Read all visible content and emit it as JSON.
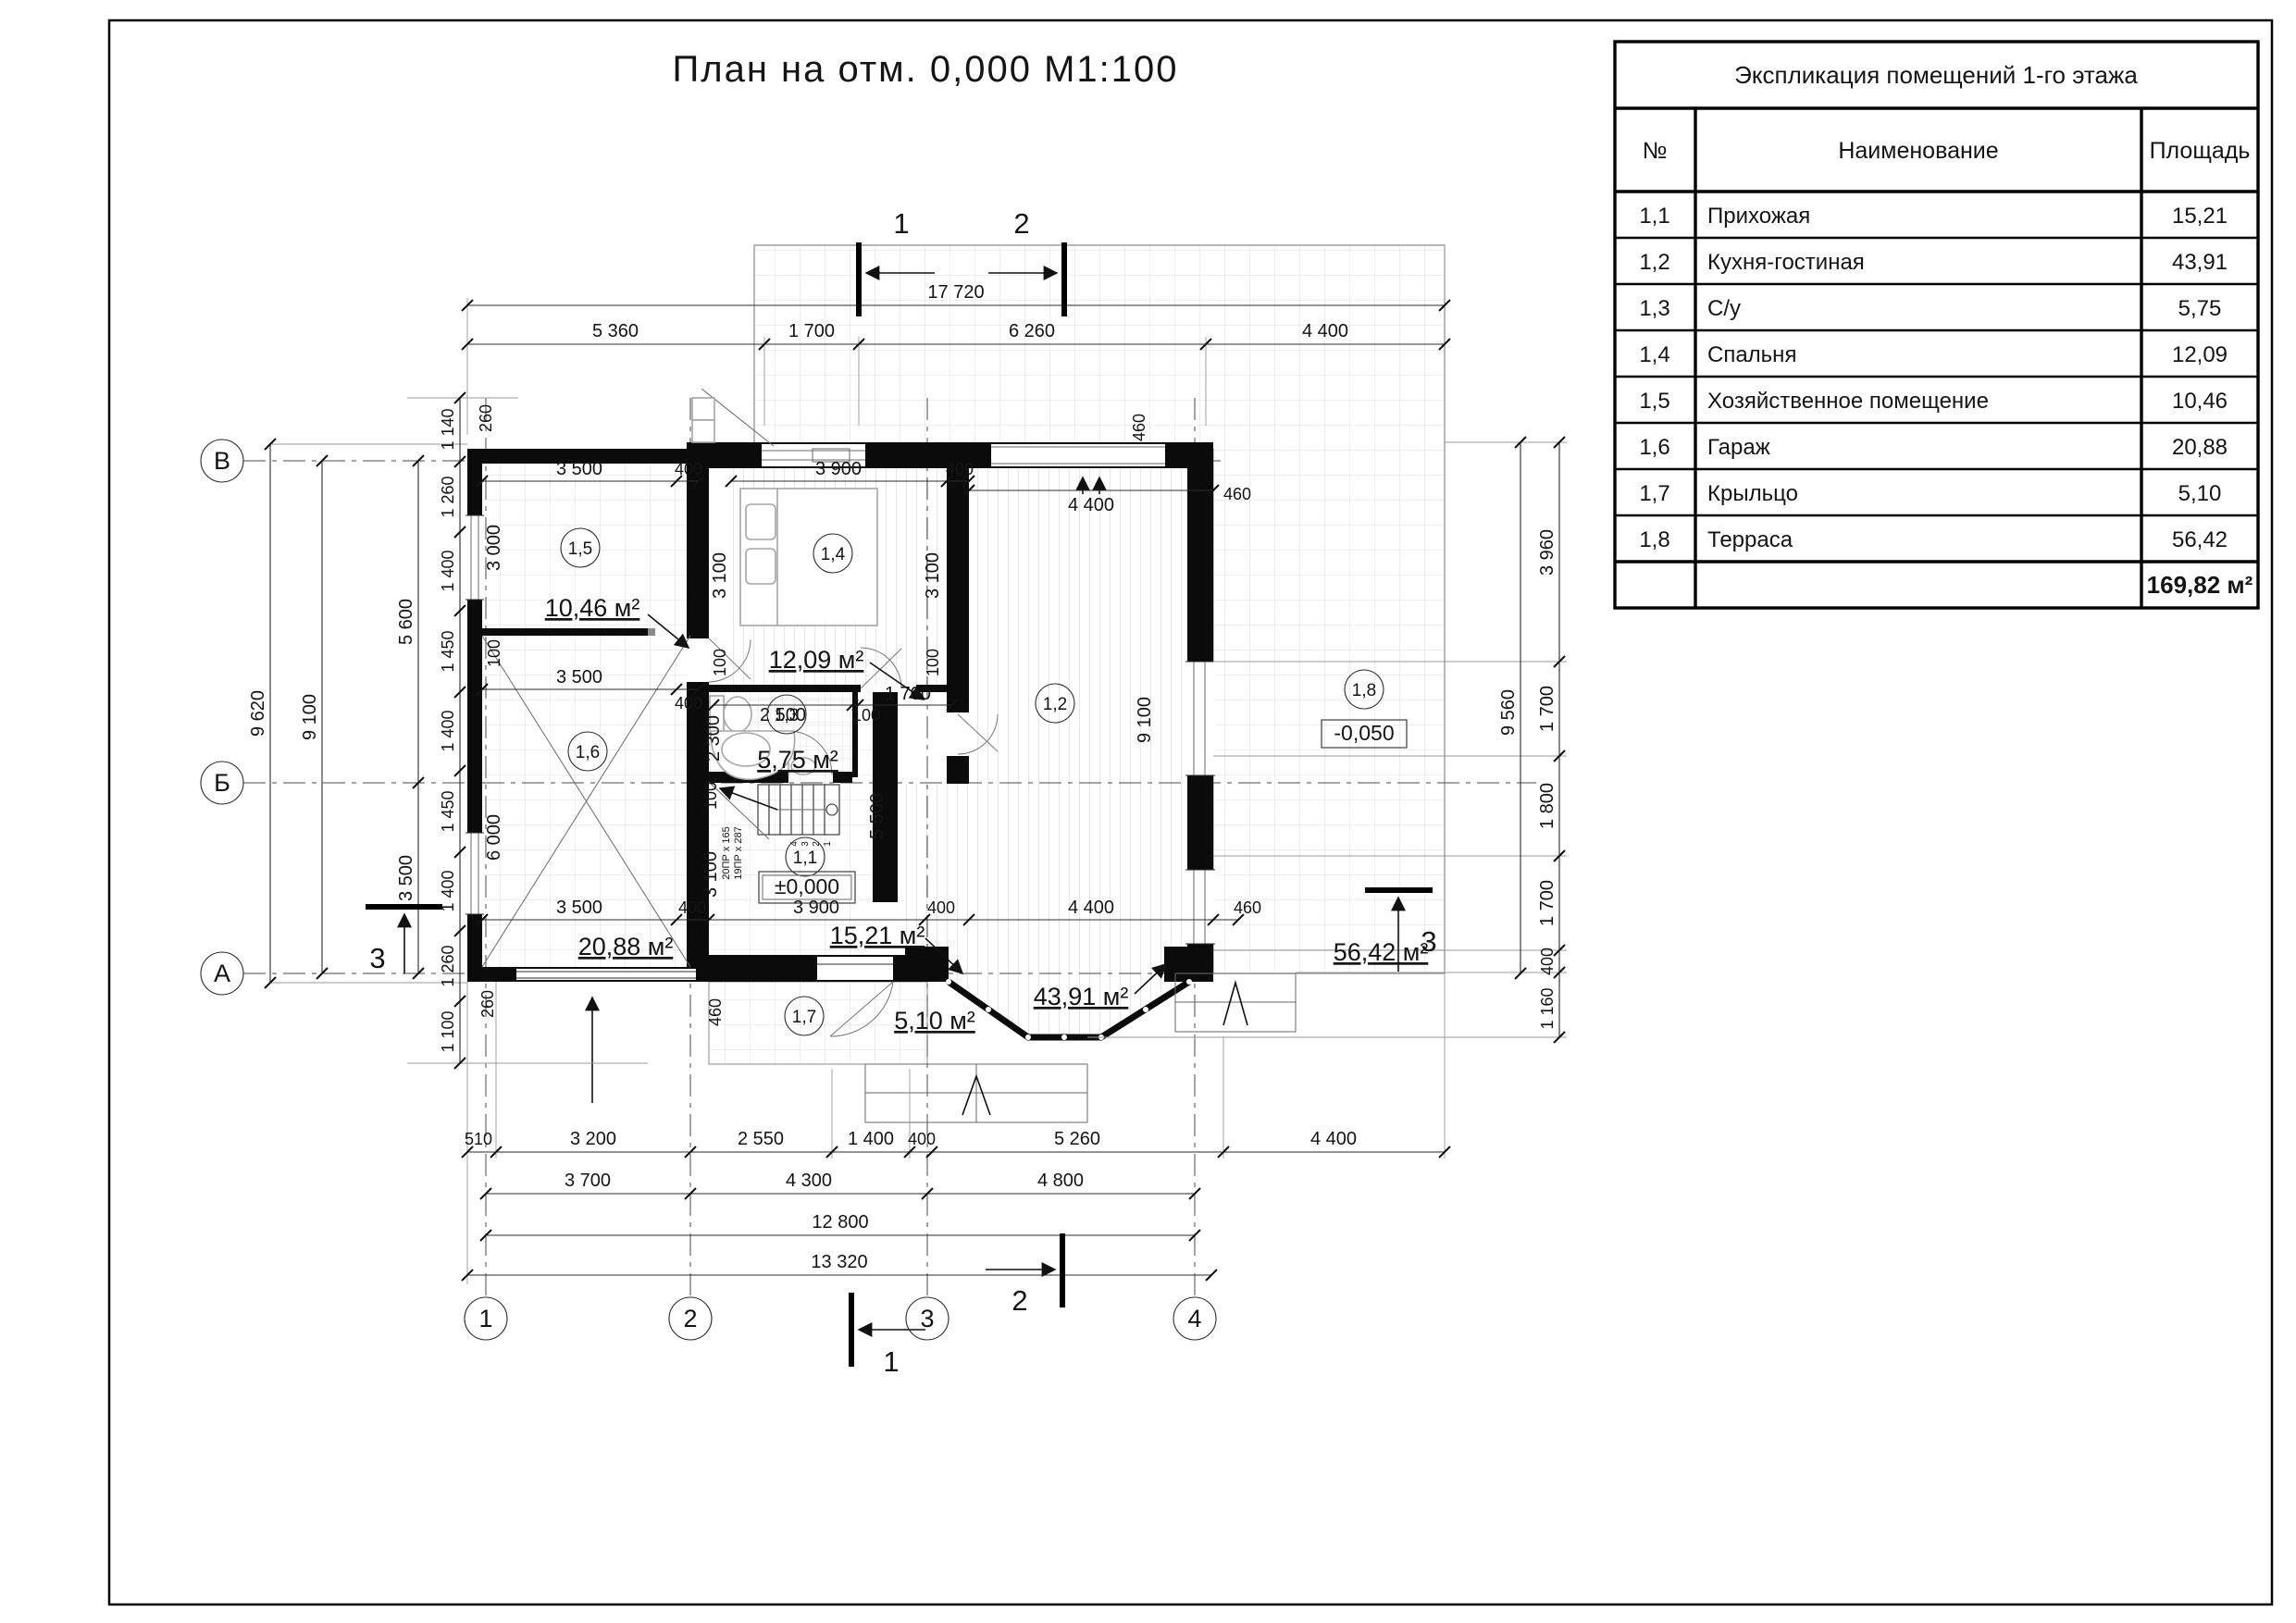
{
  "title": "План на отм. 0,000 М1:100",
  "table": {
    "title": "Экспликация помещений 1-го этажа",
    "col_num": "№",
    "col_name": "Наименование",
    "col_area": "Площадь",
    "rows": [
      {
        "num": "1,1",
        "name": "Прихожая",
        "area": "15,21"
      },
      {
        "num": "1,2",
        "name": "Кухня-гостиная",
        "area": "43,91"
      },
      {
        "num": "1,3",
        "name": "С/у",
        "area": "5,75"
      },
      {
        "num": "1,4",
        "name": "Спальня",
        "area": "12,09"
      },
      {
        "num": "1,5",
        "name": "Хозяйственное помещение",
        "area": "10,46"
      },
      {
        "num": "1,6",
        "name": "Гараж",
        "area": "20,88"
      },
      {
        "num": "1,7",
        "name": "Крыльцо",
        "area": "5,10"
      },
      {
        "num": "1,8",
        "name": "Терраса",
        "area": "56,42"
      }
    ],
    "total": "169,82 м²"
  },
  "axes": {
    "rows": [
      "В",
      "Б",
      "А"
    ],
    "cols": [
      "1",
      "2",
      "3",
      "4"
    ]
  },
  "sections": {
    "one": "1",
    "two": "2",
    "three": "3"
  },
  "levels": {
    "zero": "±0,000",
    "terrace": "-0,050"
  },
  "rooms": {
    "r11": {
      "num": "1,1",
      "area": "15,21 м²"
    },
    "r12": {
      "num": "1,2",
      "area": "43,91 м²"
    },
    "r13": {
      "num": "1,3",
      "area": "5,75 м²"
    },
    "r14": {
      "num": "1,4",
      "area": "12,09 м²"
    },
    "r15": {
      "num": "1,5",
      "area": "10,46 м²"
    },
    "r16": {
      "num": "1,6",
      "area": "20,88 м²"
    },
    "r17": {
      "num": "1,7",
      "area": "5,10 м²"
    },
    "r18": {
      "num": "1,8",
      "area": "56,42 м²"
    }
  },
  "stairs": {
    "note1": "20ПР x 165",
    "note2": "19ПР x 287",
    "s1": "1",
    "s2": "2",
    "s3": "3",
    "s4": "4"
  },
  "dims": {
    "d17720": "17 720",
    "d5360": "5 360",
    "d1700": "1 700",
    "d6260": "6 260",
    "d4400": "4 400",
    "d510": "510",
    "d3200": "3 200",
    "d2550": "2 550",
    "d1400": "1 400",
    "d400": "400",
    "d5260": "5 260",
    "d3700": "3 700",
    "d4300": "4 300",
    "d4800": "4 800",
    "d12800": "12 800",
    "d13320": "13 320",
    "d9620": "9 620",
    "d9100": "9 100",
    "d5600": "5 600",
    "d3500": "3 500",
    "d1140": "1 140",
    "d1260": "1 260",
    "d1450": "1 450",
    "d1100": "1 100",
    "d9560": "9 560",
    "d3960": "3 960",
    "d1800": "1 800",
    "d1160": "1 160",
    "d260": "260",
    "d460": "460",
    "d100": "100",
    "d3000": "3 000",
    "d6000": "6 000",
    "d3900": "3 900",
    "d3100": "3 100",
    "d2500": "2 500",
    "d2300": "2 300",
    "d5500": "5 500",
    "d9100b": "9 100"
  }
}
